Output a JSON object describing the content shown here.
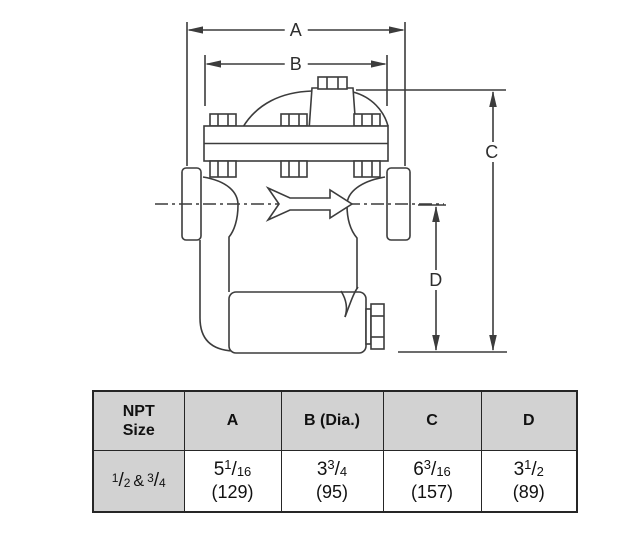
{
  "diagram": {
    "dim_labels": {
      "a": "A",
      "b": "B",
      "c": "C",
      "d": "D"
    }
  },
  "table": {
    "headers": [
      "NPT Size",
      "A",
      "B (Dia.)",
      "C",
      "D"
    ],
    "slash": "/",
    "row": {
      "size": {
        "f1n": "1",
        "f1d": "2",
        "join": "&",
        "f2n": "3",
        "f2d": "4"
      },
      "a": {
        "whole": "5",
        "num": "1",
        "den": "16",
        "metric": "(129)"
      },
      "b": {
        "whole": "3",
        "num": "3",
        "den": "4",
        "metric": "(95)"
      },
      "c": {
        "whole": "6",
        "num": "3",
        "den": "16",
        "metric": "(157)"
      },
      "d": {
        "whole": "3",
        "num": "1",
        "den": "2",
        "metric": "(89)"
      }
    }
  },
  "colors": {
    "line": "#3c3c3c",
    "table_border": "#262626",
    "table_header_bg": "#d2d2d2"
  }
}
